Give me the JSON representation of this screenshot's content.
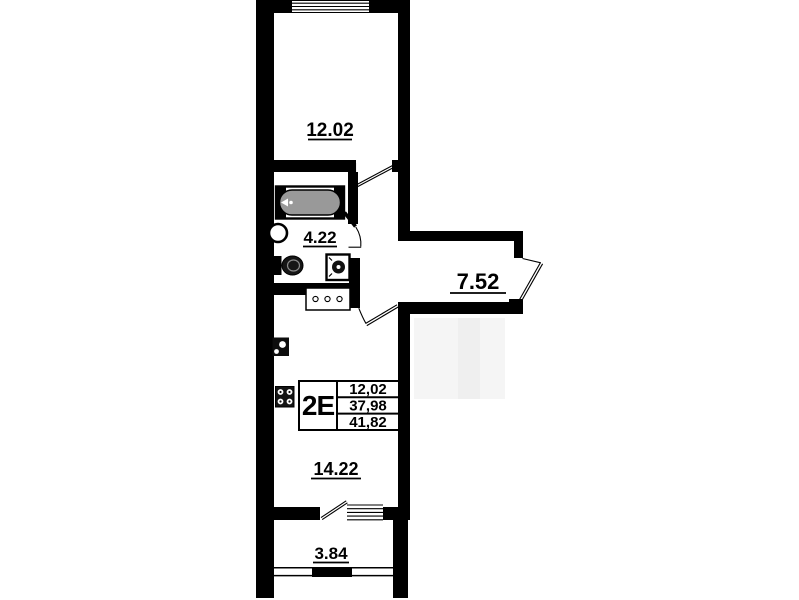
{
  "floor_plan": {
    "unit": {
      "type_label": "2E",
      "stats": [
        "12,02",
        "37,98",
        "41,82"
      ]
    },
    "room_areas": {
      "bedroom": "12.02",
      "bathroom": "4.22",
      "hallway": "7.52",
      "kitchen_living": "14.22",
      "balcony": "3.84"
    },
    "colors": {
      "wall": "#000000",
      "background": "#ffffff",
      "bathtub_fill": "#999999"
    }
  }
}
